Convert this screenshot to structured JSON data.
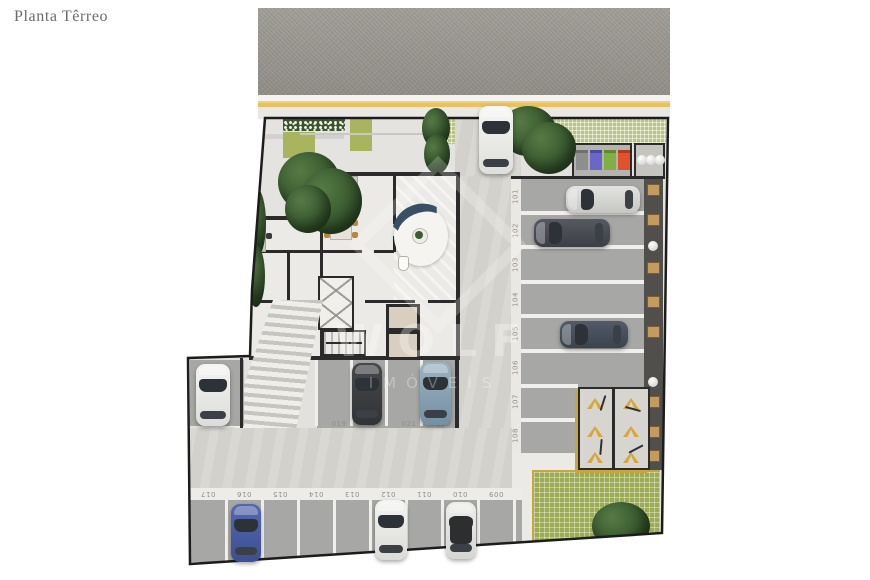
{
  "title": "Planta Têrreo",
  "watermark": {
    "brand": "WOLF",
    "line": "IMÓVEIS"
  },
  "street": {
    "surface": "asphalt",
    "center_line_color": "#e7c25e"
  },
  "facilities": {
    "bins": [
      {
        "label": "gray",
        "color": "#8e8e8e"
      },
      {
        "label": "blue",
        "color": "#6a67c9"
      },
      {
        "label": "green",
        "color": "#7fb043"
      },
      {
        "label": "red",
        "color": "#e0522f"
      }
    ],
    "gas_cylinders": 3,
    "storage_lockers": 8,
    "bike_chevrons": 6
  },
  "parking": {
    "right_column": {
      "spaces": [
        {
          "label": "101",
          "occupied": true,
          "car": "silver"
        },
        {
          "label": "102",
          "occupied": true,
          "car": "dark-gray"
        },
        {
          "label": "103",
          "occupied": false
        },
        {
          "label": "104",
          "occupied": false
        },
        {
          "label": "105",
          "occupied": true,
          "car": "dark-slate"
        },
        {
          "label": "106",
          "occupied": false
        },
        {
          "label": "107",
          "occupied": false
        },
        {
          "label": "108",
          "occupied": false
        }
      ]
    },
    "left_row": {
      "spaces": [
        {
          "label": "018",
          "occupied": true,
          "car": "white"
        },
        {
          "label": "019",
          "occupied": false
        },
        {
          "label": "020",
          "occupied": true,
          "car": "dark-gray"
        },
        {
          "label": "021",
          "occupied": false
        },
        {
          "label": "022",
          "occupied": true,
          "car": "steel-blue"
        }
      ]
    },
    "bottom_row": {
      "spaces": [
        {
          "label": "017",
          "occupied": false
        },
        {
          "label": "016",
          "occupied": true,
          "car": "blue"
        },
        {
          "label": "015",
          "occupied": false
        },
        {
          "label": "014",
          "occupied": false
        },
        {
          "label": "013",
          "occupied": false
        },
        {
          "label": "012",
          "occupied": true,
          "car": "white"
        },
        {
          "label": "011",
          "occupied": false
        },
        {
          "label": "010",
          "occupied": true,
          "car": "white-black-roof"
        },
        {
          "label": "009",
          "occupied": false
        }
      ]
    }
  },
  "colors": {
    "lawn": "#9cab56",
    "hedge": "#b9c47e",
    "chevron": "#d9a53c",
    "space_asphalt": "#a7a8a5",
    "concrete": "#d3d1cb"
  }
}
